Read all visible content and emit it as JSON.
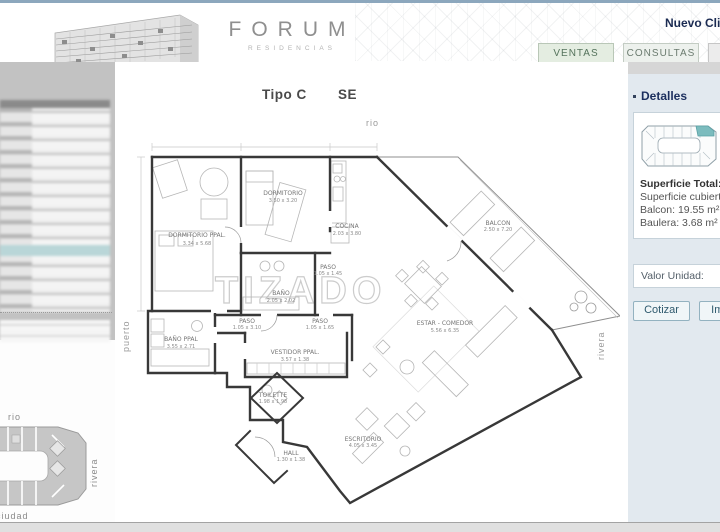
{
  "header": {
    "logo_title": "FORUM",
    "logo_subtitle": "RESIDENCIAS",
    "user_label": "Nuevo Cliente",
    "tabs": [
      {
        "label": "VENTAS"
      },
      {
        "label": "CONSULTAS"
      }
    ]
  },
  "plan": {
    "title_type": "Tipo C",
    "title_orientation": "SE",
    "watermark": "TIZADO",
    "compass": {
      "top": "rio",
      "left": "puerto",
      "right": "rivera"
    },
    "rooms": [
      {
        "name": "DORMITORIO PPAL.",
        "dims": "3.34 x 5.68"
      },
      {
        "name": "DORMITORIO",
        "dims": "3.50 x 3.20"
      },
      {
        "name": "COCINA",
        "dims": "2.03 x 3.80"
      },
      {
        "name": "BAÑO",
        "dims": "2.05 x 2.02"
      },
      {
        "name": "PASO",
        "dims": "1.05 x 1.45"
      },
      {
        "name": "BAÑO PPAL",
        "dims": "3.55 x 2.71"
      },
      {
        "name": "PASO",
        "dims": "1.05 x 3.10"
      },
      {
        "name": "PASO",
        "dims": "1.05 x 1.65"
      },
      {
        "name": "VESTIDOR PPAL.",
        "dims": "3.57 x 1.38"
      },
      {
        "name": "ESTAR - COMEDOR",
        "dims": "5.56 x 6.35"
      },
      {
        "name": "BALCON",
        "dims": "2.50 x 7.20"
      },
      {
        "name": "TOILETTE",
        "dims": "1.98 x 1.98"
      },
      {
        "name": "HALL",
        "dims": "1.30 x 1.38"
      },
      {
        "name": "ESCRITORIO",
        "dims": "4.05 x 3.45"
      }
    ]
  },
  "sidebar_right": {
    "title": "Detalles",
    "surface_total_label": "Superficie Total:",
    "surface_covered_label": "Superficie cubierta:",
    "balcony": "Balcon: 19.55 m²",
    "storage": "Baulera: 3.68 m²",
    "unit_value_label": "Valor Unidad:",
    "buttons": [
      {
        "label": "Cotizar"
      },
      {
        "label": "Imprimir"
      }
    ]
  },
  "sidebar_left": {
    "siteplan": {
      "top": "rio",
      "bottom": "ciudad",
      "right": "rivera"
    }
  },
  "colors": {
    "topline": "#8ca7bd",
    "highlight_unit": "#7cbcbe",
    "tab_active_bg": "#e4ede1",
    "sidebar_bg": "#e2e9ef"
  }
}
